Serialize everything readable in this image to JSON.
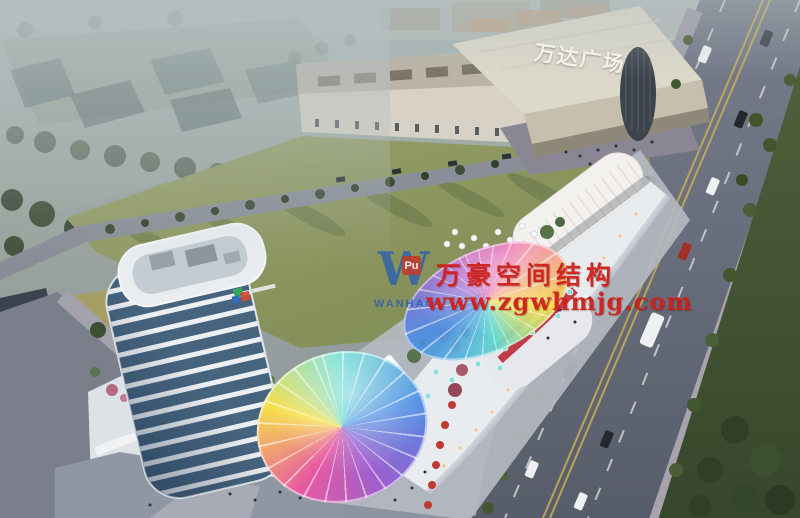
{
  "scene": {
    "description": "Aerial dusk rendering of a mixed-use commercial complex: blue-banded office tower, curved retail mall with rainbow membrane canopies, Wanda Plaza across the lawn, tree-lined avenue with traffic"
  },
  "signs": {
    "wanda_plaza": "万达广场"
  },
  "watermark": {
    "logo_letter": "W",
    "logo_badge": "Pu",
    "logo_caption": "WANHAO",
    "brand": "万豪空间结构",
    "url": "www.zgwhmjg.com"
  },
  "palette": {
    "watermark_red": "#cf1f1a",
    "watermark_blue": "#2a5fb0",
    "lawn_green": "#8e9760",
    "road_gray": "#6a6f7d",
    "tower_glass": "#47647f",
    "canopy_colors": [
      "#ef5fae",
      "#f6e04c",
      "#5fd9d0",
      "#4a8de2",
      "#9a5fd0"
    ]
  }
}
